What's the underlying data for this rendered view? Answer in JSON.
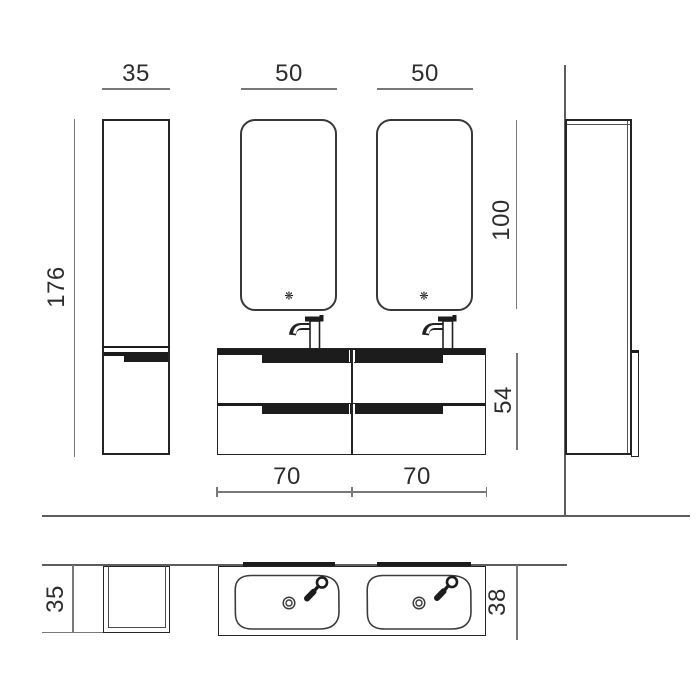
{
  "drawing": {
    "type": "bathroom vanity technical drawing, front and top views with dimensions in cm",
    "front_view": {
      "column_width": "35",
      "mirror_left_width": "50",
      "mirror_right_width": "50",
      "column_height": "176",
      "mirror_height": "100",
      "vanity_height": "54",
      "vanity_left_width": "70",
      "vanity_right_width": "70"
    },
    "top_view": {
      "column_depth": "35",
      "vanity_depth": "38"
    },
    "icons": {
      "mirror_sensor_glyph": "❋"
    },
    "colors": {
      "object_line": "#242424",
      "dim_line": "#787878",
      "wall_line": "#5d5d5d",
      "handle_fill": "#1c1c1c",
      "background": "#ffffff"
    }
  }
}
